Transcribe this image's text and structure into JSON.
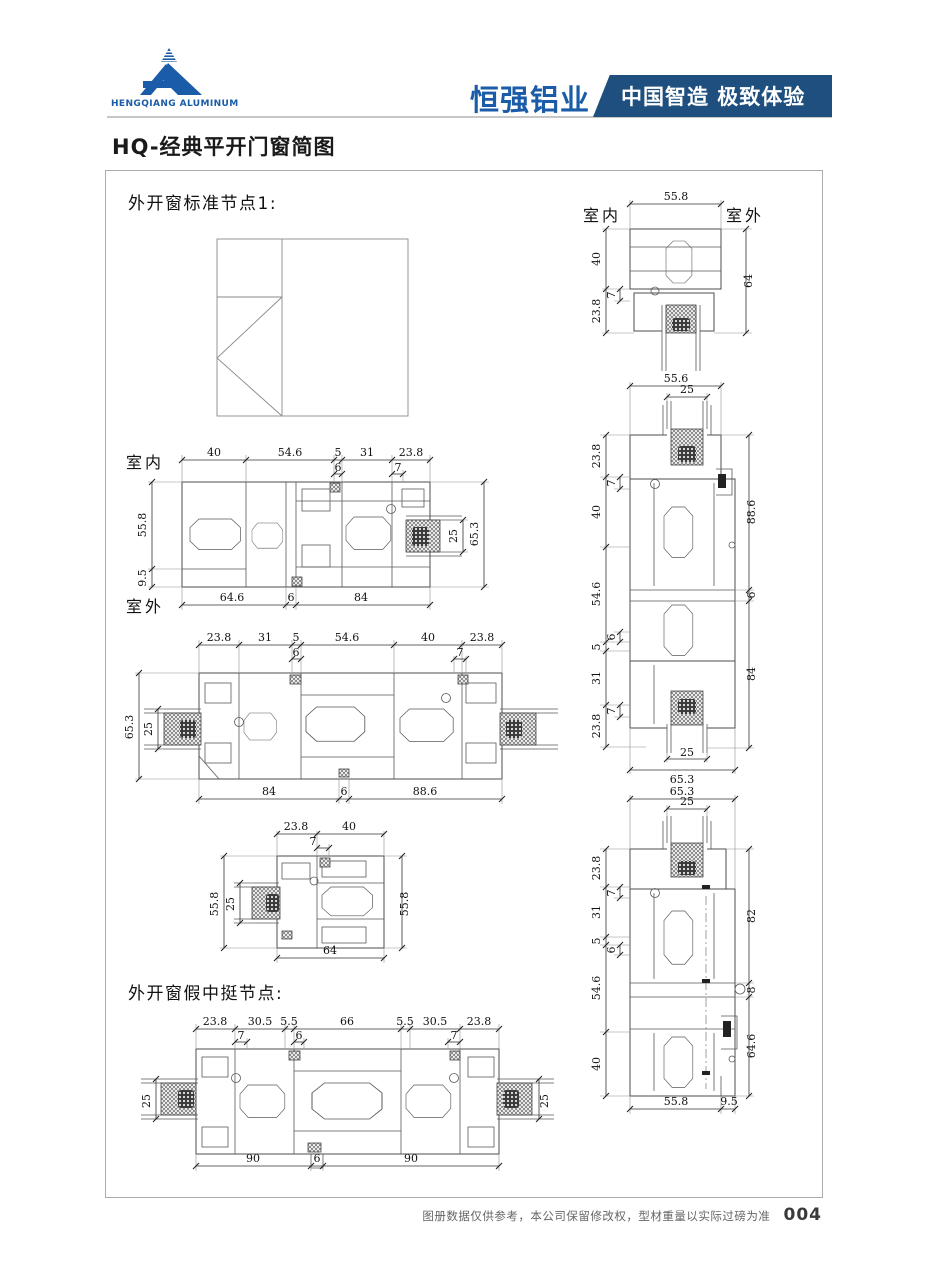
{
  "header": {
    "company_en": "HENGQIANG ALUMINUM",
    "brand_cn": "恒强铝业",
    "banner": "中国智造 极致体验"
  },
  "page_title": "HQ-经典平开门窗简图",
  "labels": {
    "indoor": "室内",
    "outdoor": "室外",
    "section1": "外开窗标准节点1:",
    "section2": "外开窗假中挺节点:"
  },
  "colors": {
    "brand_blue": "#1a5ca8",
    "banner_blue": "#1e4f7e",
    "line_gray": "#4d4d4d"
  },
  "footer": {
    "note": "图册数据仅供参考，本公司保留修改权，型材重量以实际过磅为准",
    "page_num": "004"
  },
  "diagrams": {
    "l1": {
      "top": [
        "40",
        "54.6",
        "5",
        "31",
        "23.8"
      ],
      "sub": [
        "6",
        "7"
      ],
      "left": [
        "55.8",
        "9.5"
      ],
      "right": [
        "25",
        "65.3"
      ],
      "bottom": [
        "64.6",
        "6",
        "84"
      ]
    },
    "l2": {
      "top": [
        "23.8",
        "31",
        "5",
        "54.6",
        "40",
        "23.8"
      ],
      "sub": [
        "6",
        "7"
      ],
      "left": [
        "65.3",
        "25"
      ],
      "bottom": [
        "84",
        "6",
        "88.6"
      ]
    },
    "l3": {
      "top": [
        "23.8",
        "40"
      ],
      "sub": [
        "7"
      ],
      "left": [
        "55.8",
        "25"
      ],
      "right": [
        "55.8"
      ],
      "bottom": [
        "64"
      ]
    },
    "l4": {
      "top": [
        "23.8",
        "30.5",
        "5.5",
        "66",
        "5.5",
        "30.5",
        "23.8"
      ],
      "sub": [
        "7",
        "6",
        "7"
      ],
      "left": [
        "25"
      ],
      "right": [
        "25"
      ],
      "bottom": [
        "90",
        "6",
        "90"
      ]
    },
    "r1": {
      "top": [
        "55.8"
      ],
      "left": [
        "40",
        "23.8"
      ],
      "sub": [
        "7"
      ],
      "right": [
        "64"
      ]
    },
    "r2": {
      "top": [
        "55.6",
        "25"
      ],
      "left": [
        "23.8",
        "40",
        "54.6",
        "5",
        "31",
        "23.8"
      ],
      "sub": [
        "7",
        "6",
        "7"
      ],
      "right": [
        "88.6",
        "6",
        "84"
      ],
      "bottom": [
        "25",
        "65.3"
      ]
    },
    "r3": {
      "top": [
        "65.3",
        "25"
      ],
      "left": [
        "23.8",
        "31",
        "5",
        "54.6",
        "40"
      ],
      "sub": [
        "7",
        "6"
      ],
      "right": [
        "82",
        "8",
        "64.6"
      ],
      "bottom": [
        "55.8",
        "9.5"
      ]
    }
  }
}
